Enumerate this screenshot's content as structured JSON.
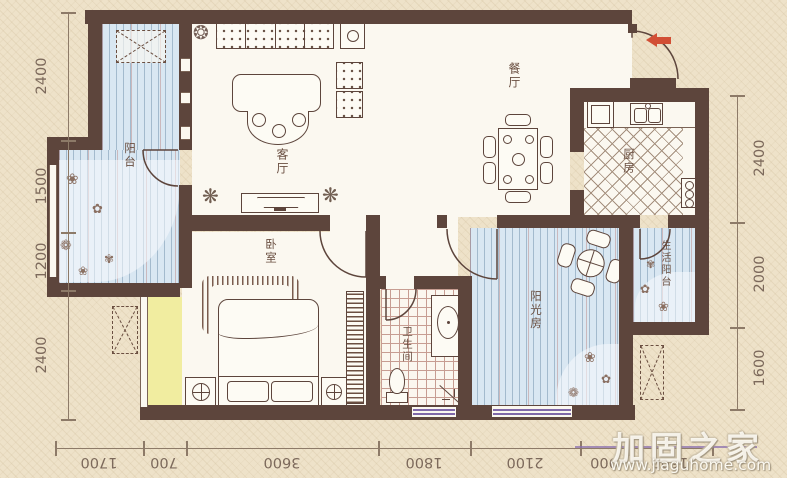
{
  "rooms": {
    "balcony": "阳台",
    "living_room": "客厅",
    "dining_room": "餐厅",
    "kitchen": "厨房",
    "bedroom": "卧室",
    "bathroom": "卫生间",
    "sunroom": "阳光房",
    "service_balcony": "生活阳台"
  },
  "dimensions": {
    "left": [
      "2400",
      "1500",
      "1200",
      "2400"
    ],
    "right": [
      "2400",
      "2000",
      "1600"
    ],
    "bottom": [
      "1700",
      "700",
      "3600",
      "1800",
      "2100",
      "900",
      "1600"
    ]
  },
  "watermark": {
    "brand": "加固之家",
    "url": "www.jiaguhome.com"
  },
  "colors": {
    "wall_brown": "#5d453c",
    "floor_blue": "#d9e7f2",
    "bay_yellow": "#f1eda0",
    "entry_arrow_red": "#d24f35",
    "background_beige": "#eee2c9",
    "window_purple": "#7f68a8"
  }
}
